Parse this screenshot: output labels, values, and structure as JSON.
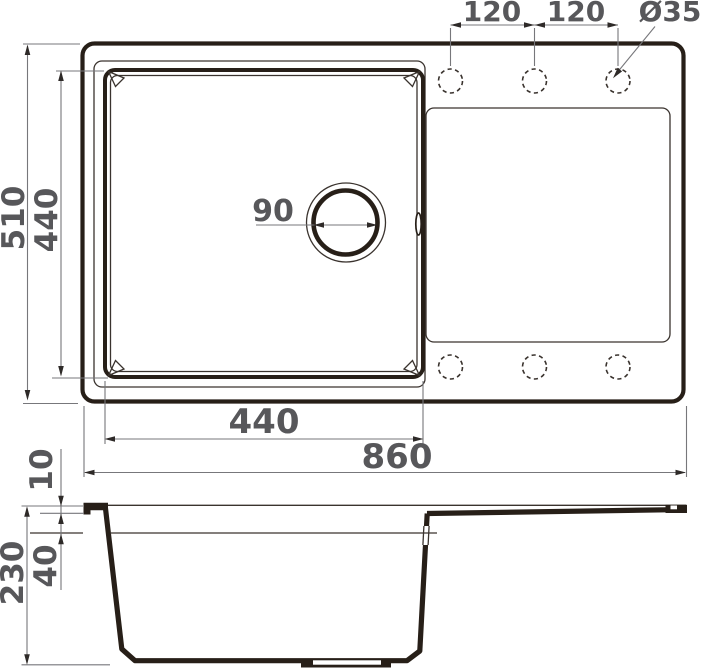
{
  "diagram": {
    "type": "technical-drawing",
    "subject": "kitchen sink with square bowl and drainboard, top view and cross-section",
    "colors": {
      "main_line": "#271f18",
      "thin_line": "#3a332e",
      "dimension_line": "#77777b",
      "arrow": "#2e2a28",
      "text": "#57575a",
      "background": "#ffffff"
    },
    "top_view": {
      "faucet_holes": {
        "count": 6,
        "diameter_label": "Ø35"
      },
      "dimensions": {
        "hole_spacing_left": "120",
        "hole_spacing_right": "120",
        "hole_diameter": "Ø35",
        "overall_length": "860",
        "overall_width": "510",
        "bowl_length": "440",
        "bowl_width": "440",
        "drain_diameter": "90"
      }
    },
    "side_view": {
      "dimensions": {
        "overall_height": "230",
        "rim_thickness": "10",
        "upper_ledge_depth": "40"
      }
    }
  }
}
